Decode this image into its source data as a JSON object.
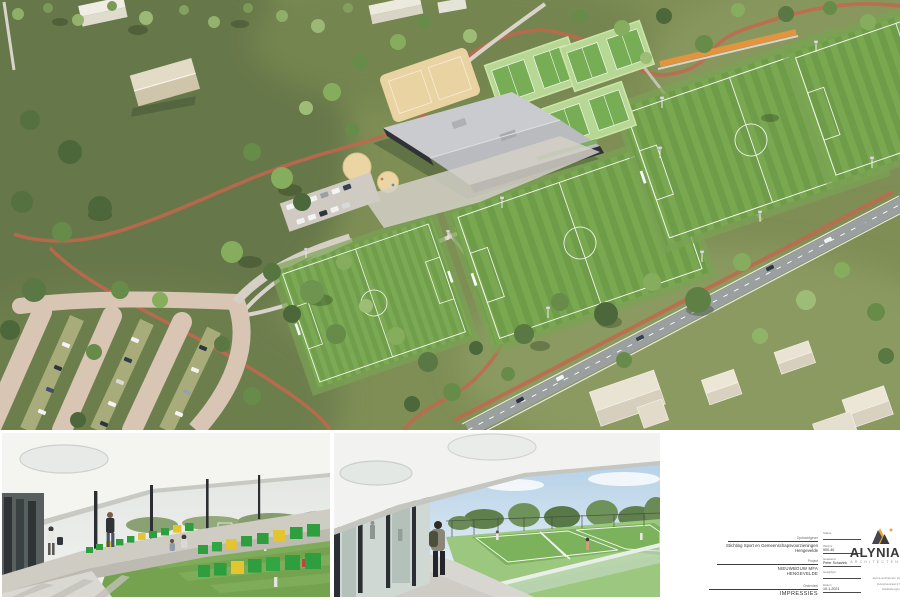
{
  "sheet": {
    "kind": "architectural impression sheet",
    "background": "#ffffff"
  },
  "aerial_view": {
    "description": "aerial-render-sports-complex",
    "colors": {
      "grass": "#7e8e55",
      "grass_dark": "#66774a",
      "pitch_stripe_a": "#7aa851",
      "pitch_stripe_b": "#6f9c48",
      "tennis_pad": "#b7d794",
      "tennis_court": "#77ad55",
      "sand": "#ead3a3",
      "path_light": "#d8d4cb",
      "parking_loop": "#d9c5b3",
      "cycle_path_red": "#c2674e",
      "track_orange": "#e2943e",
      "road_gray": "#9aa09f",
      "roof_light": "#c9cbce",
      "facade_dark": "#2f3236",
      "house_beige": "#e9e3d4"
    }
  },
  "photos": {
    "left": {
      "description": "grandstand-walkway-render",
      "seat_green": "#2f9e3f",
      "seat_yellow": "#e3c52f"
    },
    "middle": {
      "description": "terrace-tennis-courts-render",
      "sky": "#a9c9e3"
    }
  },
  "titleblock": {
    "client_label": "Opdrachtgever",
    "client_line1": "Stichting Sport en Gemeenschapsvoorzieningen",
    "client_line2": "Hengevelde",
    "project_label": "Project",
    "project_line1": "NIEUWBOUW MFA",
    "project_line2": "HENGEVELDE",
    "part_label": "Onderdeel",
    "part": "IMPRESSIES",
    "fields": [
      {
        "label": "Status",
        "value": ""
      },
      {
        "label": "Werknr",
        "value": "900-40"
      },
      {
        "label": "Getekend",
        "value": "Peter Schavink"
      },
      {
        "label": "Gewijzigd",
        "value": ""
      },
      {
        "label": "Datum",
        "value": "10-1-2021"
      }
    ],
    "logo": {
      "name": "ALYNIA",
      "sub": "ARCHITECTEN",
      "accent_orange": "#efa63c",
      "dark": "#3a3a3c"
    },
    "address_lines": [
      "alynia architecten bv",
      "Industriestraat 27",
      "Haaksbergen"
    ]
  }
}
